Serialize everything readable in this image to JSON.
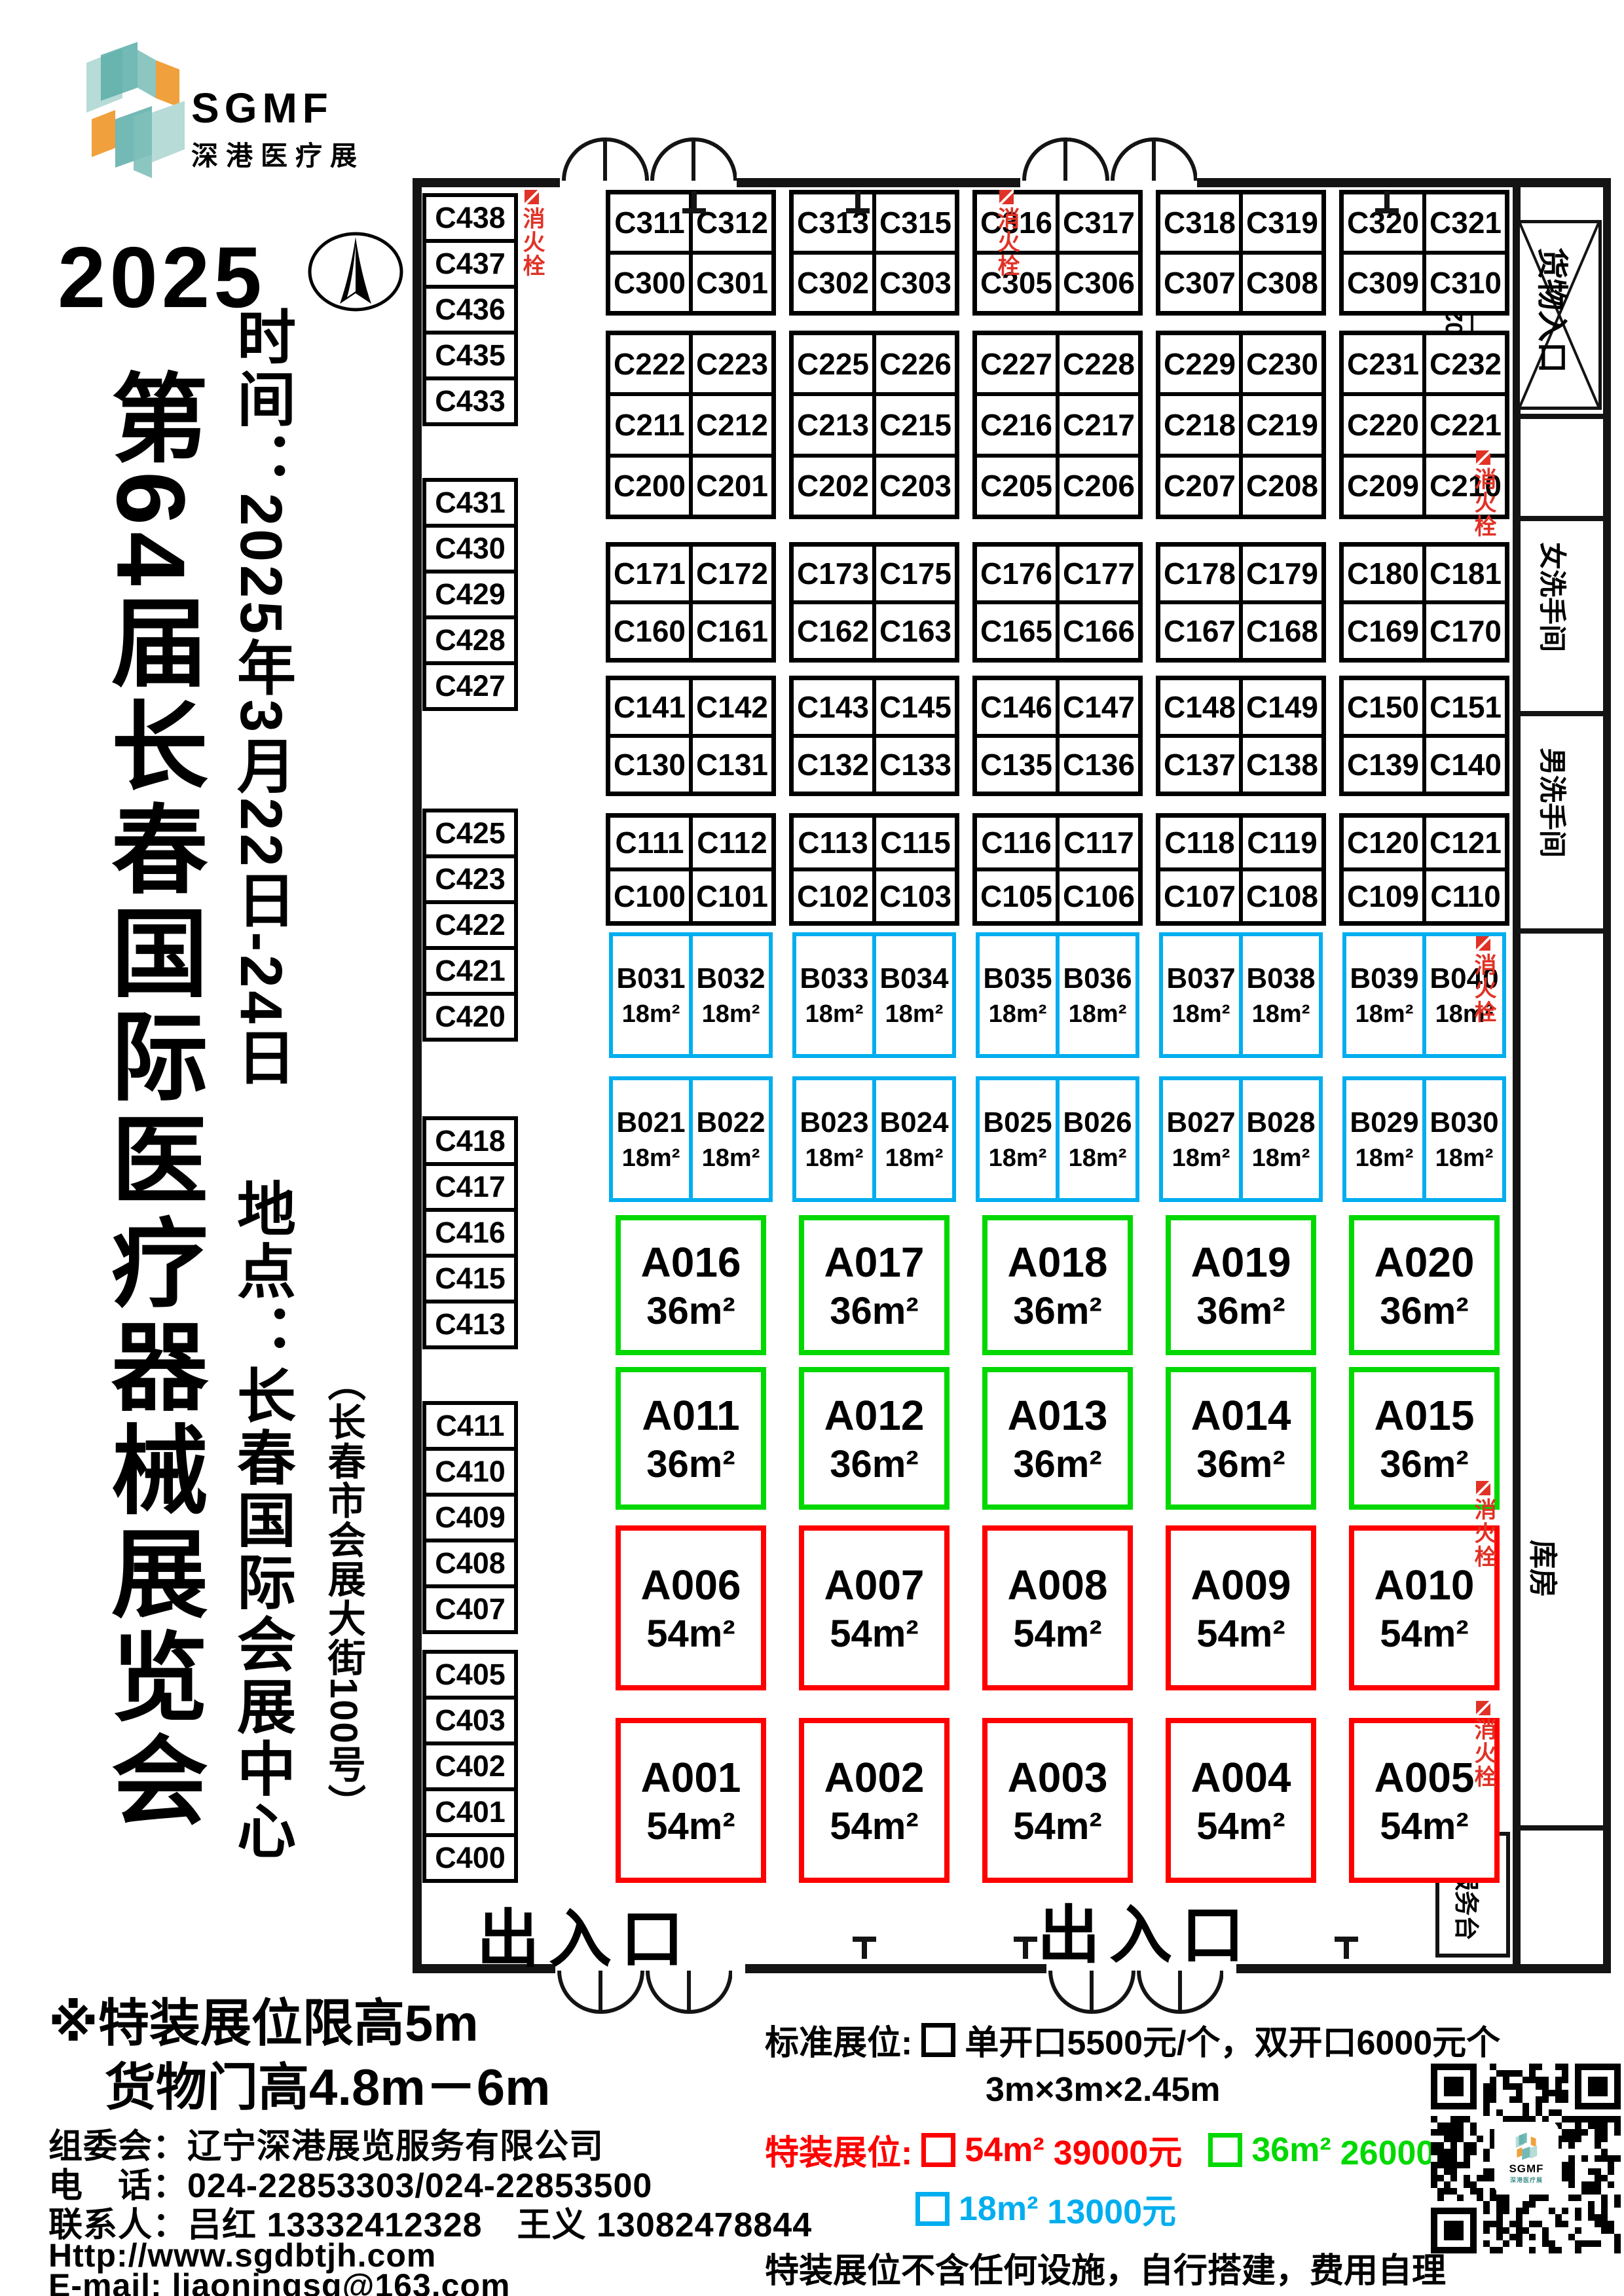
{
  "logo": {
    "brand": "SGMF",
    "subtitle": "深港医疗展"
  },
  "header": {
    "year": "2025",
    "title": "第64届长春国际医疗器械展览会",
    "time": "时间：2025年3月22日-24日",
    "venue": "地点：长春国际会展中心",
    "address": "（长春市会展大街100号）"
  },
  "floorplan": {
    "labels": {
      "cargo_entrance": "货物入口",
      "cargo_dim": "5025",
      "women_restroom": "女洗手间",
      "men_restroom": "男洗手间",
      "storage": "库房",
      "service_desk": "总服务台",
      "entrance_exit": "出入口",
      "fire_hydrant": "消火栓"
    },
    "left_column_groups": [
      [
        "C438",
        "C437",
        "C436",
        "C435",
        "C433"
      ],
      [
        "C431",
        "C430",
        "C429",
        "C428",
        "C427"
      ],
      [
        "C425",
        "C423",
        "C422",
        "C421",
        "C420"
      ],
      [
        "C418",
        "C417",
        "C416",
        "C415",
        "C413"
      ],
      [
        "C411",
        "C410",
        "C409",
        "C408",
        "C407"
      ],
      [
        "C405",
        "C403",
        "C402",
        "C401",
        "C400"
      ]
    ],
    "booth_rows": [
      {
        "kind": "c",
        "groups": [
          [
            [
              "C311",
              "C312"
            ],
            [
              "C300",
              "C301"
            ]
          ],
          [
            [
              "C313",
              "C315"
            ],
            [
              "C302",
              "C303"
            ]
          ],
          [
            [
              "C316",
              "C317"
            ],
            [
              "C305",
              "C306"
            ]
          ],
          [
            [
              "C318",
              "C319"
            ],
            [
              "C307",
              "C308"
            ]
          ],
          [
            [
              "C320",
              "C321"
            ],
            [
              "C309",
              "C310"
            ]
          ]
        ]
      },
      {
        "kind": "c",
        "groups": [
          [
            [
              "C222",
              "C223"
            ],
            [
              "C211",
              "C212"
            ],
            [
              "C200",
              "C201"
            ]
          ],
          [
            [
              "C225",
              "C226"
            ],
            [
              "C213",
              "C215"
            ],
            [
              "C202",
              "C203"
            ]
          ],
          [
            [
              "C227",
              "C228"
            ],
            [
              "C216",
              "C217"
            ],
            [
              "C205",
              "C206"
            ]
          ],
          [
            [
              "C229",
              "C230"
            ],
            [
              "C218",
              "C219"
            ],
            [
              "C207",
              "C208"
            ]
          ],
          [
            [
              "C231",
              "C232"
            ],
            [
              "C220",
              "C221"
            ],
            [
              "C209",
              "C210"
            ]
          ]
        ]
      },
      {
        "kind": "c",
        "groups": [
          [
            [
              "C171",
              "C172"
            ],
            [
              "C160",
              "C161"
            ]
          ],
          [
            [
              "C173",
              "C175"
            ],
            [
              "C162",
              "C163"
            ]
          ],
          [
            [
              "C176",
              "C177"
            ],
            [
              "C165",
              "C166"
            ]
          ],
          [
            [
              "C178",
              "C179"
            ],
            [
              "C167",
              "C168"
            ]
          ],
          [
            [
              "C180",
              "C181"
            ],
            [
              "C169",
              "C170"
            ]
          ]
        ]
      },
      {
        "kind": "c",
        "groups": [
          [
            [
              "C141",
              "C142"
            ],
            [
              "C130",
              "C131"
            ]
          ],
          [
            [
              "C143",
              "C145"
            ],
            [
              "C132",
              "C133"
            ]
          ],
          [
            [
              "C146",
              "C147"
            ],
            [
              "C135",
              "C136"
            ]
          ],
          [
            [
              "C148",
              "C149"
            ],
            [
              "C137",
              "C138"
            ]
          ],
          [
            [
              "C150",
              "C151"
            ],
            [
              "C139",
              "C140"
            ]
          ]
        ]
      },
      {
        "kind": "c",
        "groups": [
          [
            [
              "C111",
              "C112"
            ],
            [
              "C100",
              "C101"
            ]
          ],
          [
            [
              "C113",
              "C115"
            ],
            [
              "C102",
              "C103"
            ]
          ],
          [
            [
              "C116",
              "C117"
            ],
            [
              "C105",
              "C106"
            ]
          ],
          [
            [
              "C118",
              "C119"
            ],
            [
              "C107",
              "C108"
            ]
          ],
          [
            [
              "C120",
              "C121"
            ],
            [
              "C109",
              "C110"
            ]
          ]
        ]
      },
      {
        "kind": "b",
        "area": "18m²",
        "groups": [
          [
            "B031",
            "B032"
          ],
          [
            "B033",
            "B034"
          ],
          [
            "B035",
            "B036"
          ],
          [
            "B037",
            "B038"
          ],
          [
            "B039",
            "B040"
          ]
        ]
      },
      {
        "kind": "b",
        "area": "18m²",
        "groups": [
          [
            "B021",
            "B022"
          ],
          [
            "B023",
            "B024"
          ],
          [
            "B025",
            "B026"
          ],
          [
            "B027",
            "B028"
          ],
          [
            "B029",
            "B030"
          ]
        ]
      },
      {
        "kind": "a",
        "area": "36m²",
        "color": "green",
        "booths": [
          "A016",
          "A017",
          "A018",
          "A019",
          "A020"
        ]
      },
      {
        "kind": "a",
        "area": "36m²",
        "color": "green",
        "booths": [
          "A011",
          "A012",
          "A013",
          "A014",
          "A015"
        ]
      },
      {
        "kind": "a",
        "area": "54m²",
        "color": "red",
        "booths": [
          "A006",
          "A007",
          "A008",
          "A009",
          "A010"
        ]
      },
      {
        "kind": "a",
        "area": "54m²",
        "color": "red",
        "booths": [
          "A001",
          "A002",
          "A003",
          "A004",
          "A005"
        ]
      }
    ]
  },
  "notes": {
    "height_limit": "※特装展位限高5m",
    "cargo_door_height": "货物门高4.8m－6m"
  },
  "contact": {
    "organizer": "组委会：辽宁深港展览服务有限公司",
    "phone": "电　话：024-22853303/024-22853500",
    "persons": "联系人：吕红 13332412328　王义 13082478844",
    "website": "Http://www.sgdbtjh.com",
    "email": "E-mail: liaoningsg@163.com"
  },
  "pricing": {
    "standard_label": "标准展位:",
    "standard_price": "单开口5500元/个，双开口6000元个",
    "standard_size": "3m×3m×2.45m",
    "special_label": "特装展位:",
    "options": [
      {
        "size": "54m²",
        "price": "39000元",
        "color": "#ff0000"
      },
      {
        "size": "36m²",
        "price": "26000元",
        "color": "#00d800"
      },
      {
        "size": "18m²",
        "price": "13000元",
        "color": "#00aeef"
      }
    ],
    "note": "特装展位不含任何设施，自行搭建，费用自理"
  },
  "colors": {
    "booth_blue": "#00aeef",
    "booth_green": "#00d800",
    "booth_red": "#ff0000",
    "hydrant_red": "#e03226",
    "logo_teal": "#5aada8",
    "logo_teal_light": "#b7dbd7",
    "logo_orange": "#f0a03c"
  }
}
